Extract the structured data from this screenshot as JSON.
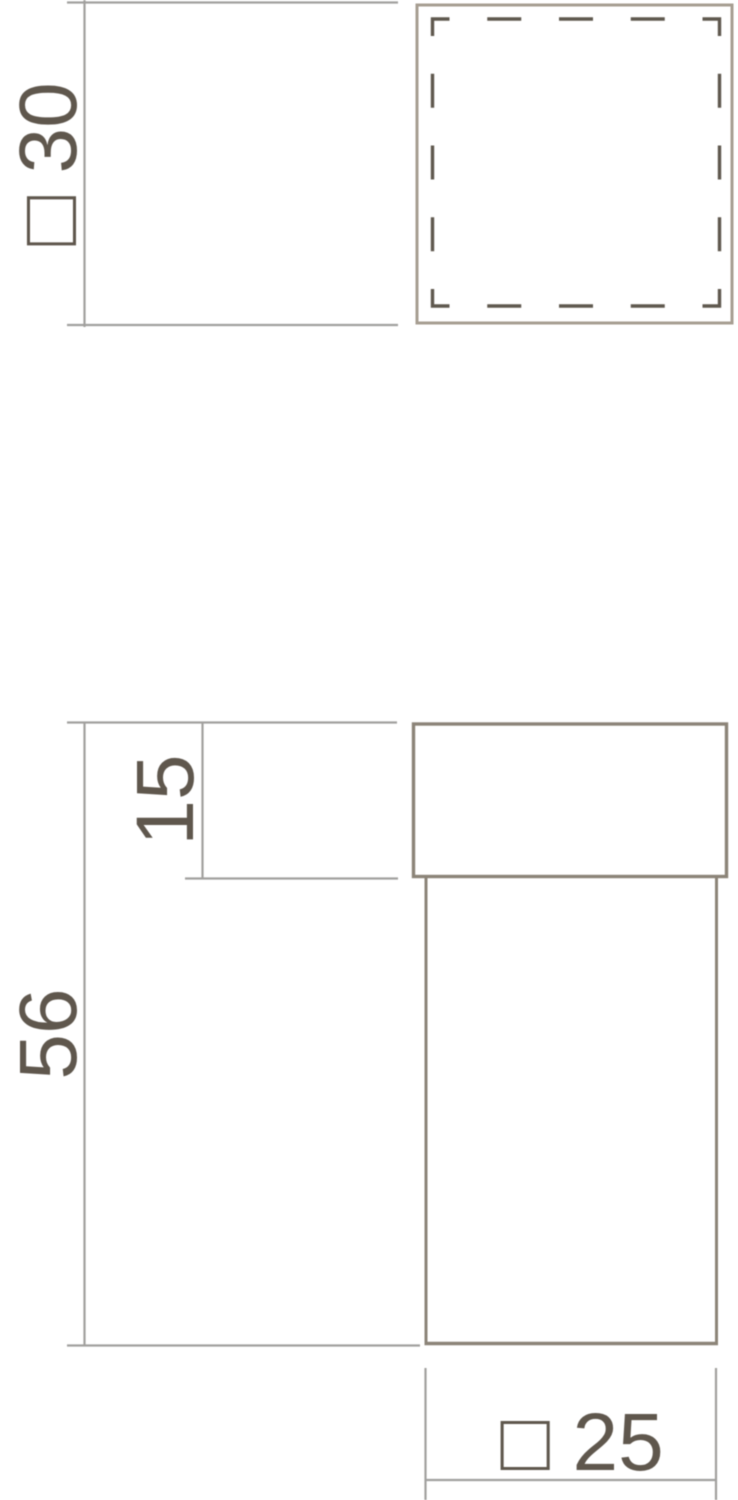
{
  "drawing": {
    "labels": {
      "top_view_size": "□ 30",
      "cap_height": "15",
      "total_height": "56",
      "base_size": "□ 25"
    },
    "colors": {
      "object_line": "#8c8478",
      "top_view_outline": "#a79e92",
      "hidden_line": "#5f584e",
      "dimension_line": "#a1a09e",
      "label_text": "#5f574d"
    }
  }
}
